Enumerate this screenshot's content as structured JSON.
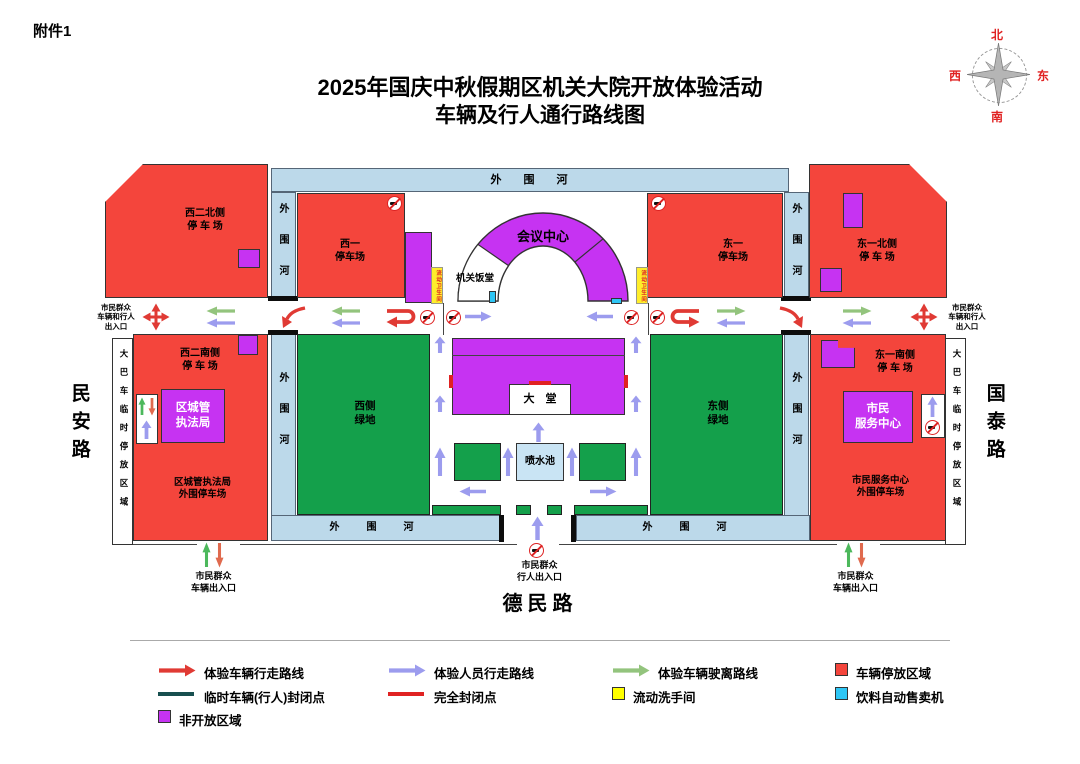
{
  "doc": {
    "attachment": "附件1",
    "title1": "2025年国庆中秋假期区机关大院开放体验活动",
    "title2": "车辆及行人通行路线图"
  },
  "compass": {
    "n": "北",
    "e": "东",
    "s": "南",
    "w": "西"
  },
  "roads": {
    "west": "民安路",
    "east": "国泰路",
    "south": "德民路"
  },
  "river": {
    "name": "外围河"
  },
  "strips": {
    "bus": "大巴车临时停放区域",
    "toilet": "流动卫生间"
  },
  "areas": {
    "w2n": [
      "西二北侧",
      "停 车 场"
    ],
    "w1": [
      "西一",
      "停车场"
    ],
    "e1": [
      "东一",
      "停车场"
    ],
    "e1n": [
      "东一北侧",
      "停 车 场"
    ],
    "w2s": [
      "西二南侧",
      "停 车 场"
    ],
    "e1s": [
      "东一南侧",
      "停 车 场"
    ],
    "law": [
      "区城管",
      "执法局"
    ],
    "lawOuter": [
      "区城管执法局",
      "外围停车场"
    ],
    "civic": [
      "市民",
      "服务中心"
    ],
    "civicOuter": [
      "市民服务中心",
      "外围停车场"
    ],
    "westGreen": [
      "西侧",
      "绿地"
    ],
    "eastGreen": [
      "东侧",
      "绿地"
    ]
  },
  "buildings": {
    "conference": "会议中心",
    "canteen": "机关饭堂",
    "lobby": "大　堂",
    "fountain": "喷水池"
  },
  "entrances": {
    "sideLines": [
      "市民群众",
      "车辆和行人",
      "出入口"
    ],
    "vehicle": [
      "市民群众",
      "车辆出入口"
    ],
    "pedestrian": [
      "市民群众",
      "行人出入口"
    ]
  },
  "legend": {
    "items": [
      {
        "label": "体验车辆行走路线",
        "type": "arrow",
        "color": "#e03a34"
      },
      {
        "label": "体验人员行走路线",
        "type": "arrow",
        "color": "#9c9cee"
      },
      {
        "label": "体验车辆驶离路线",
        "type": "arrow",
        "color": "#93c47d"
      },
      {
        "label": "车辆停放区域",
        "type": "square",
        "color": "#f4453c"
      },
      {
        "label": "临时车辆(行人)封闭点",
        "type": "line",
        "color": "#174f4f"
      },
      {
        "label": "完全封闭点",
        "type": "line",
        "color": "#e02222"
      },
      {
        "label": "流动洗手间",
        "type": "square",
        "color": "#ffff00"
      },
      {
        "label": "饮料自动售卖机",
        "type": "square",
        "color": "#2ec6f5"
      },
      {
        "label": "非开放区域",
        "type": "square",
        "color": "#c633f2"
      }
    ]
  },
  "colors": {
    "parking": "#f4453c",
    "nonOpen": "#c633f2",
    "lawn": "#14a04b",
    "river": "#bcd9ea",
    "vehicleRoute": "#e03a34",
    "personnelRoute": "#9c9cee",
    "departRoute": "#93c47d",
    "tempClosure": "#174f4f",
    "fullClosure": "#e02222",
    "toilet": "#ffff00",
    "vending": "#2ec6f5"
  }
}
